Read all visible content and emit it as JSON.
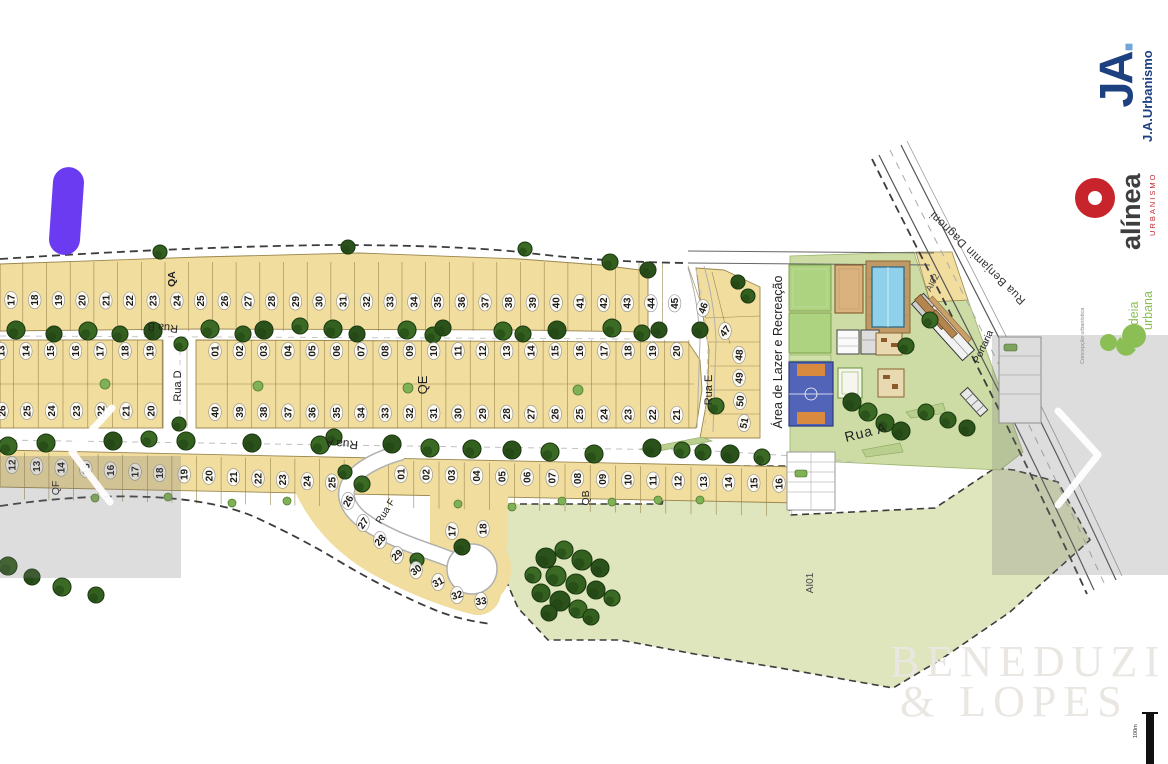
{
  "plan": {
    "streets": {
      "rua_a": "Rua A",
      "rua_b": "Rua B",
      "rua_d": "Rua D",
      "rua_e": "Rua E",
      "rua_f": "Rua F",
      "rua_benjamin": "Rua Benjamin Dagnoni"
    },
    "areas": {
      "lazer": "Área de Lazer e Recreação",
      "portaria": "Portaria",
      "ai01": "AI01",
      "ai02": "AI02"
    },
    "blocks": {
      "qa": {
        "label": "QA",
        "numbers": [
          "17",
          "18",
          "19",
          "20",
          "21",
          "22",
          "23",
          "24",
          "25",
          "26",
          "27",
          "28",
          "29",
          "30",
          "31",
          "32",
          "33",
          "34",
          "35",
          "36",
          "37",
          "38",
          "39",
          "40",
          "41",
          "42",
          "43",
          "44",
          "45"
        ],
        "wedge": [
          "46",
          "47",
          "48",
          "49",
          "50",
          "51"
        ]
      },
      "left": {
        "top": [
          "13",
          "14",
          "15",
          "16",
          "17",
          "18",
          "19"
        ],
        "bottom": [
          "26",
          "25",
          "24",
          "23",
          "22",
          "21",
          "20"
        ]
      },
      "qe": {
        "label": "QE",
        "top": [
          "01",
          "02",
          "03",
          "04",
          "05",
          "06",
          "07",
          "08",
          "09",
          "10",
          "11",
          "12",
          "13",
          "14",
          "15",
          "16",
          "17",
          "18",
          "19",
          "20"
        ],
        "bottom": [
          "40",
          "39",
          "38",
          "37",
          "36",
          "35",
          "34",
          "33",
          "32",
          "31",
          "30",
          "29",
          "28",
          "27",
          "26",
          "25",
          "24",
          "23",
          "22",
          "21"
        ]
      },
      "qf": {
        "label": "QF",
        "row": [
          "12",
          "13",
          "14",
          "15",
          "16",
          "17",
          "18",
          "19",
          "20",
          "21",
          "22",
          "23",
          "24",
          "25"
        ],
        "curve": [
          "26",
          "27",
          "28",
          "29",
          "30",
          "31",
          "32",
          "33"
        ]
      },
      "qb": {
        "label": "QB",
        "row": [
          "01",
          "02",
          "03",
          "04",
          "05",
          "06",
          "07",
          "08",
          "09",
          "10",
          "11",
          "12",
          "13",
          "14",
          "15",
          "16"
        ],
        "pocket": [
          "17",
          "18"
        ]
      }
    }
  },
  "branding": {
    "ja": {
      "glyph_main": "JA",
      "glyph_dot": ".",
      "name": "J.A.Urbanismo"
    },
    "alinea": {
      "name": "alínea",
      "tagline": "URBANISMO"
    },
    "ideia": {
      "line1": "ideia",
      "line2": "urbana",
      "credit": "Concepção urbanística"
    },
    "watermark": {
      "line1": "BENEDUZI",
      "line2": "& LOPES"
    }
  },
  "scale": {
    "label": "100m"
  },
  "colors": {
    "lot_fill": "#f1dd9e",
    "green_area": "#dfe5bd",
    "lawn": "#ccdca4",
    "tree": "#33601e",
    "court_blue": "#5264b8",
    "pool_blue": "#8fd0ea",
    "accent_purple": "#6a3bf0",
    "brand_blue": "#1d4080",
    "brand_red": "#c8242b",
    "brand_green": "#8bbf55"
  }
}
